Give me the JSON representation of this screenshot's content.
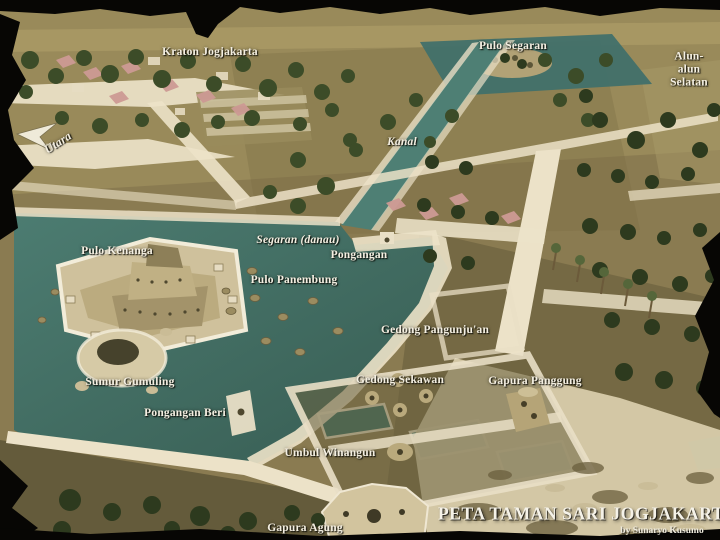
{
  "map": {
    "title": "PETA TAMAN SARI JOGJAKARTA",
    "credit": "by Sunaryo Kusumo",
    "compass": {
      "label": "Utara",
      "direction": "north"
    },
    "labels": {
      "kraton_jogjakarta": "Kraton Jogjakarta",
      "pulo_segaran": "Pulo Segaran",
      "alun_alun_selatan": "Alun-alun\nSelatan",
      "kanal": "Kanal",
      "segaran_danau": "Segaran (danau)",
      "pongangan": "Pongangan",
      "pulo_kenanga": "Pulo Kenanga",
      "pulo_panembung": "Pulo Panembung",
      "gedong_pangunjuan": "Gedong Pangunju'an",
      "gedong_sekawan": "Gedong Sekawan",
      "gapura_panggung": "Gapura Panggung",
      "sumur_gumuling": "Sumur Gumuling",
      "pongangan_beri": "Pongangan Beri",
      "umbul_winangun": "Umbul Winangun",
      "gapura_agung": "Gapura Agung"
    },
    "colors": {
      "water": "#41706a",
      "ground": "#8a7b51",
      "path": "#ece2c8",
      "tree": "#3c4c28",
      "torn_edge": "#070604",
      "label_text": "#f4efe2"
    }
  }
}
